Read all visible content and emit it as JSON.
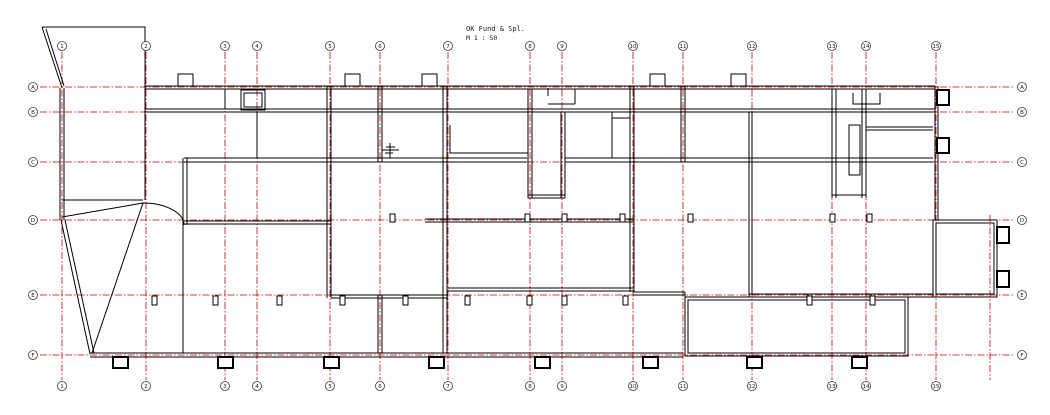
{
  "title": {
    "name": "OK Fund & Spl.",
    "scale": "M 1 : 50"
  },
  "colors": {
    "background": "#ffffff",
    "walls": "#000000",
    "grid_line": "#c00000",
    "bubble_stroke": "#3a3a3a"
  },
  "grid": {
    "columns": [
      {
        "label": "1",
        "x": 62
      },
      {
        "label": "2",
        "x": 146
      },
      {
        "label": "3",
        "x": 225
      },
      {
        "label": "4",
        "x": 257
      },
      {
        "label": "5",
        "x": 330
      },
      {
        "label": "6",
        "x": 380
      },
      {
        "label": "7",
        "x": 448
      },
      {
        "label": "8",
        "x": 530
      },
      {
        "label": "9",
        "x": 562
      },
      {
        "label": "10",
        "x": 633
      },
      {
        "label": "11",
        "x": 683
      },
      {
        "label": "12",
        "x": 752
      },
      {
        "label": "13",
        "x": 832
      },
      {
        "label": "14",
        "x": 866
      },
      {
        "label": "15",
        "x": 936
      }
    ],
    "minor_column_x": 990,
    "rows": [
      {
        "label": "A",
        "y": 87
      },
      {
        "label": "B",
        "y": 112
      },
      {
        "label": "C",
        "y": 162
      },
      {
        "label": "D",
        "y": 220
      },
      {
        "label": "E",
        "y": 295
      },
      {
        "label": "F",
        "y": 355
      }
    ],
    "bubble_top_y": 46,
    "bubble_bottom_y": 386,
    "bubble_left_x": 33,
    "bubble_right_x": 1022,
    "line_top_y": 52,
    "line_bottom_y": 380,
    "line_left_x": 40,
    "line_right_x": 1015
  },
  "plan": {
    "piers_row_d": {
      "y": 214,
      "w": 5,
      "h": 8,
      "xs": [
        390,
        525,
        562,
        620,
        688,
        830,
        867
      ]
    },
    "piers_row_e": {
      "y": 296,
      "w": 5,
      "h": 9,
      "xs": [
        152,
        213,
        277,
        340,
        403,
        465,
        527,
        562,
        623,
        807,
        870
      ]
    },
    "top_tabs": {
      "y": 74,
      "w": 15,
      "h": 12,
      "xs": [
        178,
        345,
        422,
        650,
        731
      ]
    },
    "bottom_tabs": {
      "y": 357,
      "w": 15,
      "h": 11,
      "xs": [
        113,
        218,
        324,
        429,
        535,
        643,
        747,
        852
      ]
    },
    "side_tabs": [
      {
        "x": 937,
        "y": 90,
        "w": 12,
        "h": 15
      },
      {
        "x": 937,
        "y": 138,
        "w": 12,
        "h": 15
      },
      {
        "x": 997,
        "y": 227,
        "w": 12,
        "h": 16
      },
      {
        "x": 997,
        "y": 271,
        "w": 12,
        "h": 16
      }
    ]
  }
}
